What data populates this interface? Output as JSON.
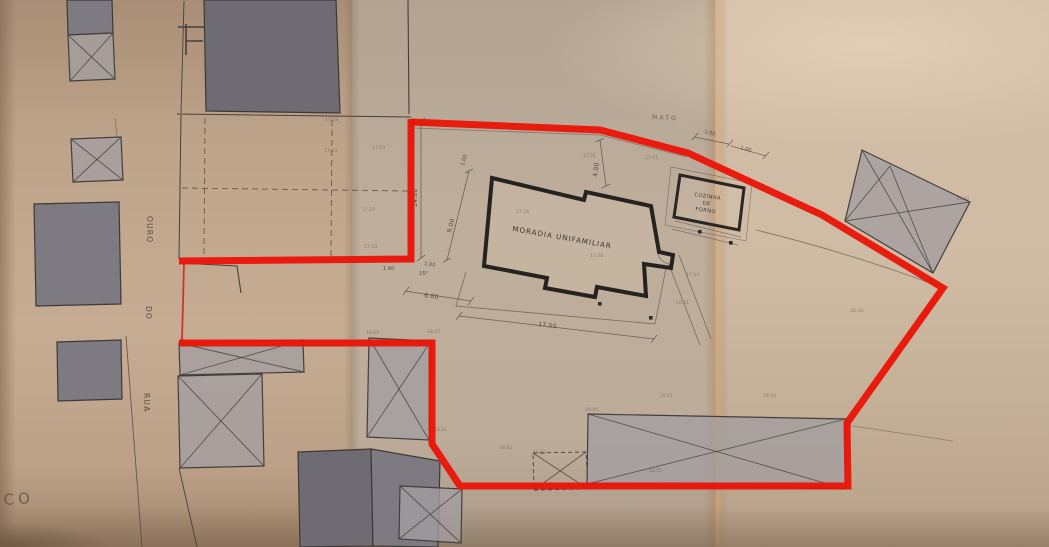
{
  "plan": {
    "labels": {
      "main_building": "MORADIA UNIFAMILIAR",
      "annex_line1": "COZINHA",
      "annex_line2": "DE",
      "annex_line3": "FORNO",
      "vegetation": "MATO",
      "street_word_top": "OURO",
      "street_word_mid": "DO",
      "street_word_bottom": "RUA",
      "edge_fragment": "CO"
    },
    "dimensions": {
      "boundary_left": "14.00",
      "house_side": "9.00",
      "house_top": "4.00",
      "house_length": "17.50",
      "front_width": "6.00",
      "front_offset": "1.60",
      "angle": "15°",
      "offset_a": "1.00",
      "offset_b": "1.00",
      "offset_c": "1.00",
      "offset_d": "1.00"
    },
    "levels": [
      "17.18",
      "17.03",
      "17.10",
      "17.27",
      "17.43",
      "17.21",
      "17.61",
      "17.26",
      "17.36",
      "17.54",
      "18.01",
      "18.60",
      "18.47",
      "18.61",
      "18.82",
      "19.02",
      "19.11",
      "19.10",
      "19.05",
      "18.55",
      "18.43",
      "15.80"
    ],
    "colors": {
      "boundary": "#e91508",
      "paper": "#c6b098",
      "ink": "#45403c",
      "building_fill": "#7e7a82",
      "hatch_fill": "#a39ea1"
    }
  }
}
